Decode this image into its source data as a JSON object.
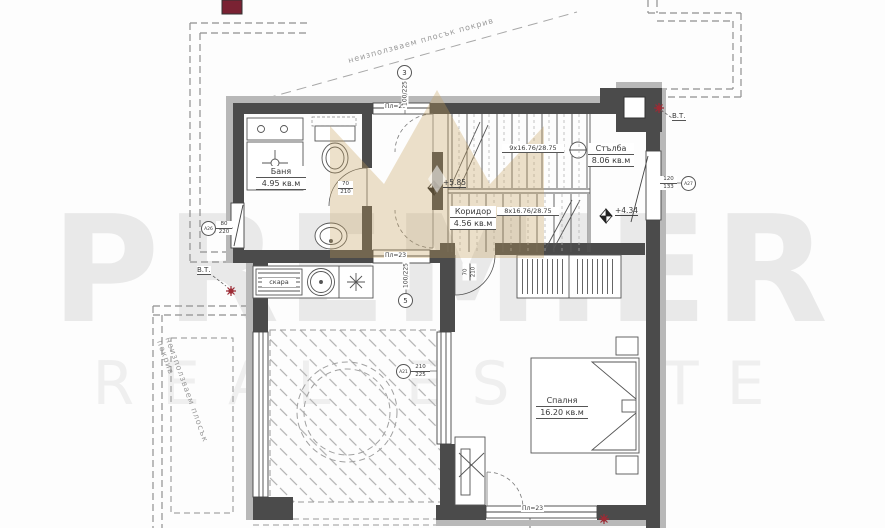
{
  "watermark": {
    "line1": "PREMIER",
    "line2": "REAL ESTATE",
    "crown_color": "#c6a35c"
  },
  "roof": {
    "note": "неизползваем плосък покрив"
  },
  "rooms": {
    "bathroom": {
      "name": "Баня",
      "area": "4.95 кв.м"
    },
    "corridor": {
      "name": "Коридор",
      "area": "4.56 кв.м"
    },
    "staircase": {
      "name": "Стълба",
      "area": "8.06 кв.м"
    },
    "bedroom": {
      "name": "Спалня",
      "area": "16.20 кв.м"
    }
  },
  "kitchen": {
    "grill_label": "скара"
  },
  "stairs": {
    "flight_up": "9x16.76/28.75",
    "flight_down": "8x16.76/28.75"
  },
  "levels": {
    "upper": "+5.85",
    "lower": "+4.34"
  },
  "vents": {
    "label": "В.Т."
  },
  "doors": {
    "sliding_label": "Пл=23",
    "bath_door": {
      "w": "70",
      "h": "210"
    },
    "bedroom_door": {
      "w": "70",
      "h": "210"
    }
  },
  "openings": {
    "o3": {
      "ref": "3",
      "size": "100/225"
    },
    "o5": {
      "ref": "5",
      "size": "100/225"
    },
    "a27": {
      "ref": "А27",
      "w": "120",
      "h": "133"
    },
    "a26": {
      "ref": "А26",
      "w": "80",
      "h": "220"
    },
    "a21": {
      "ref": "А21",
      "w": "210",
      "h": "225"
    }
  }
}
